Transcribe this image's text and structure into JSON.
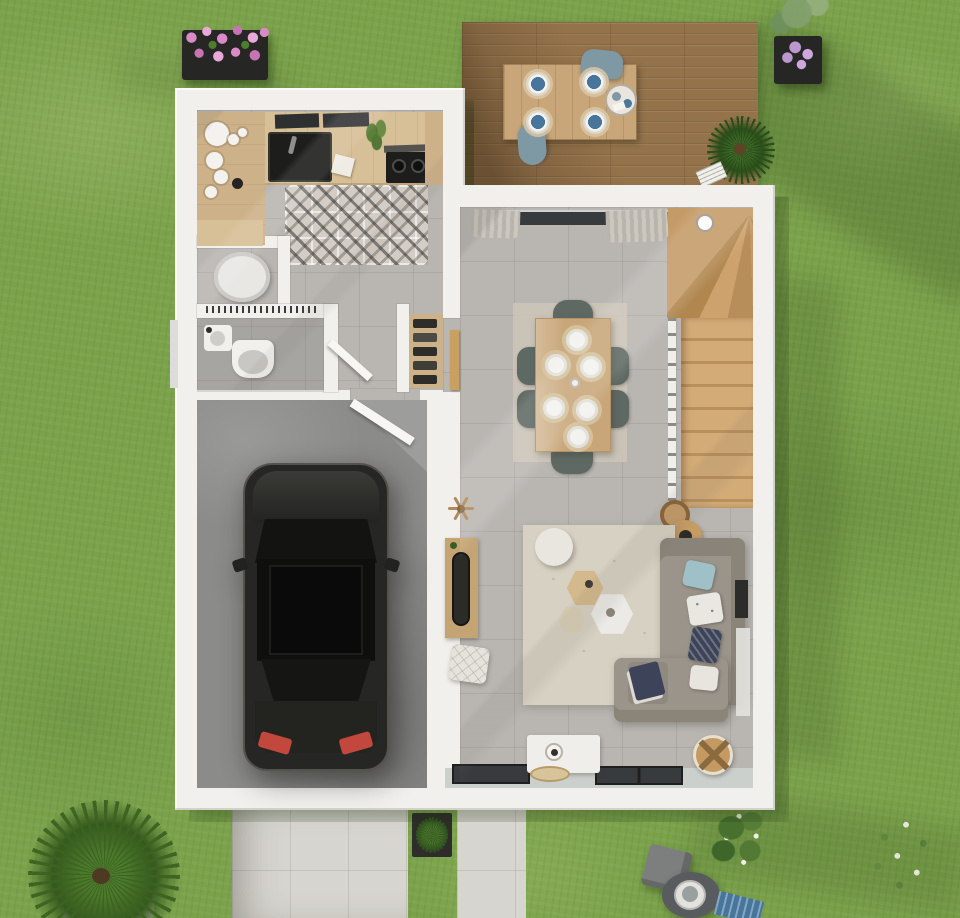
{
  "scene": {
    "kind": "3d-floor-plan-render",
    "view": "top-down",
    "objects": [
      "lawn",
      "cast-shadows",
      "wooden-terrace-deck",
      "outdoor-dining-table",
      "outdoor-chairs",
      "blue-place-settings",
      "serving-tray",
      "terrace-yucca-plant",
      "magazine",
      "flower-box-pink",
      "potted-shrub-lilac",
      "house-shell",
      "kitchen-counter",
      "kitchen-sink",
      "induction-hob",
      "cooker-hood",
      "open-shelves-crockery",
      "cement-tile-floor",
      "counter-plant",
      "water-heater-closet",
      "wc-toilet",
      "wc-hand-basin",
      "hall-storage-shelves",
      "open-door-wc",
      "open-door-garage",
      "wooden-door-hall",
      "garage",
      "car-top-view",
      "staircase-with-winders",
      "newel-post",
      "wall-clock",
      "sliding-bay-window",
      "curtains",
      "dining-table",
      "dining-chairs",
      "dinner-plates",
      "dining-rug",
      "living-rug",
      "corner-sofa",
      "cushions",
      "ottoman-with-blanket",
      "hexagonal-coffee-tables",
      "round-pouf",
      "quilted-pouf",
      "console-with-mirror",
      "coat-stand",
      "tv-sideboard",
      "table-lamp",
      "woven-plate",
      "wicker-basket",
      "bottom-windows",
      "window-sill",
      "wall-tv-panel",
      "side-curtain",
      "driveway-tiles",
      "garden-walkway",
      "square-planter-green",
      "palm-bush",
      "flowering-shrub",
      "angular-gray-pot",
      "round-planter",
      "striped-lounger-cushion",
      "twiggy-white-flower-bush",
      "lamp-side-table"
    ]
  },
  "colors": {
    "grass": "#7ba24b",
    "grass_light": "#93b964",
    "grass_dark": "#5e8a38",
    "garden_shadow": "rgba(28,50,14,0.20)",
    "wall": "#f2f0ec",
    "wall_shade": "#d9d6d0",
    "tile": "#b9b6b2",
    "garage_floor": "#8b8b89",
    "deck_wood": "#94734b",
    "table_wood_outdoor": "#c8a679",
    "stair_wood": "#c49a66",
    "stair_wood_light": "#d2ab77",
    "kitchen_wood": "#d7bf97",
    "counter_wood": "#cdb189",
    "appliance_black": "#1d1d1c",
    "car_body": "#262624",
    "car_glass": "#131312",
    "car_trim": "#55524c",
    "tail_light": "#c2473c",
    "sofa": "#9a948b",
    "sofa_dark": "#8b8579",
    "rug": "#d7d1c3",
    "rug_dining": "#cdc6b7",
    "chair_sage": "#5f6963",
    "plate_white": "#f2f1ee",
    "outdoor_chair": "#7e98a4",
    "plate_blue": "#47759c",
    "navy": "#3d4459",
    "light_blue": "#9fc0c6",
    "path": "#d7d5cf",
    "pot_black": "#262624",
    "flower_pink": "#d98bc8",
    "flower_lilac": "#bd97cf",
    "foliage": "#4e7d2e",
    "jute": "#c59a62",
    "glass": "#383b3e",
    "wood_door": "#c9a061",
    "toilet_gray": "#c9c7c3"
  }
}
